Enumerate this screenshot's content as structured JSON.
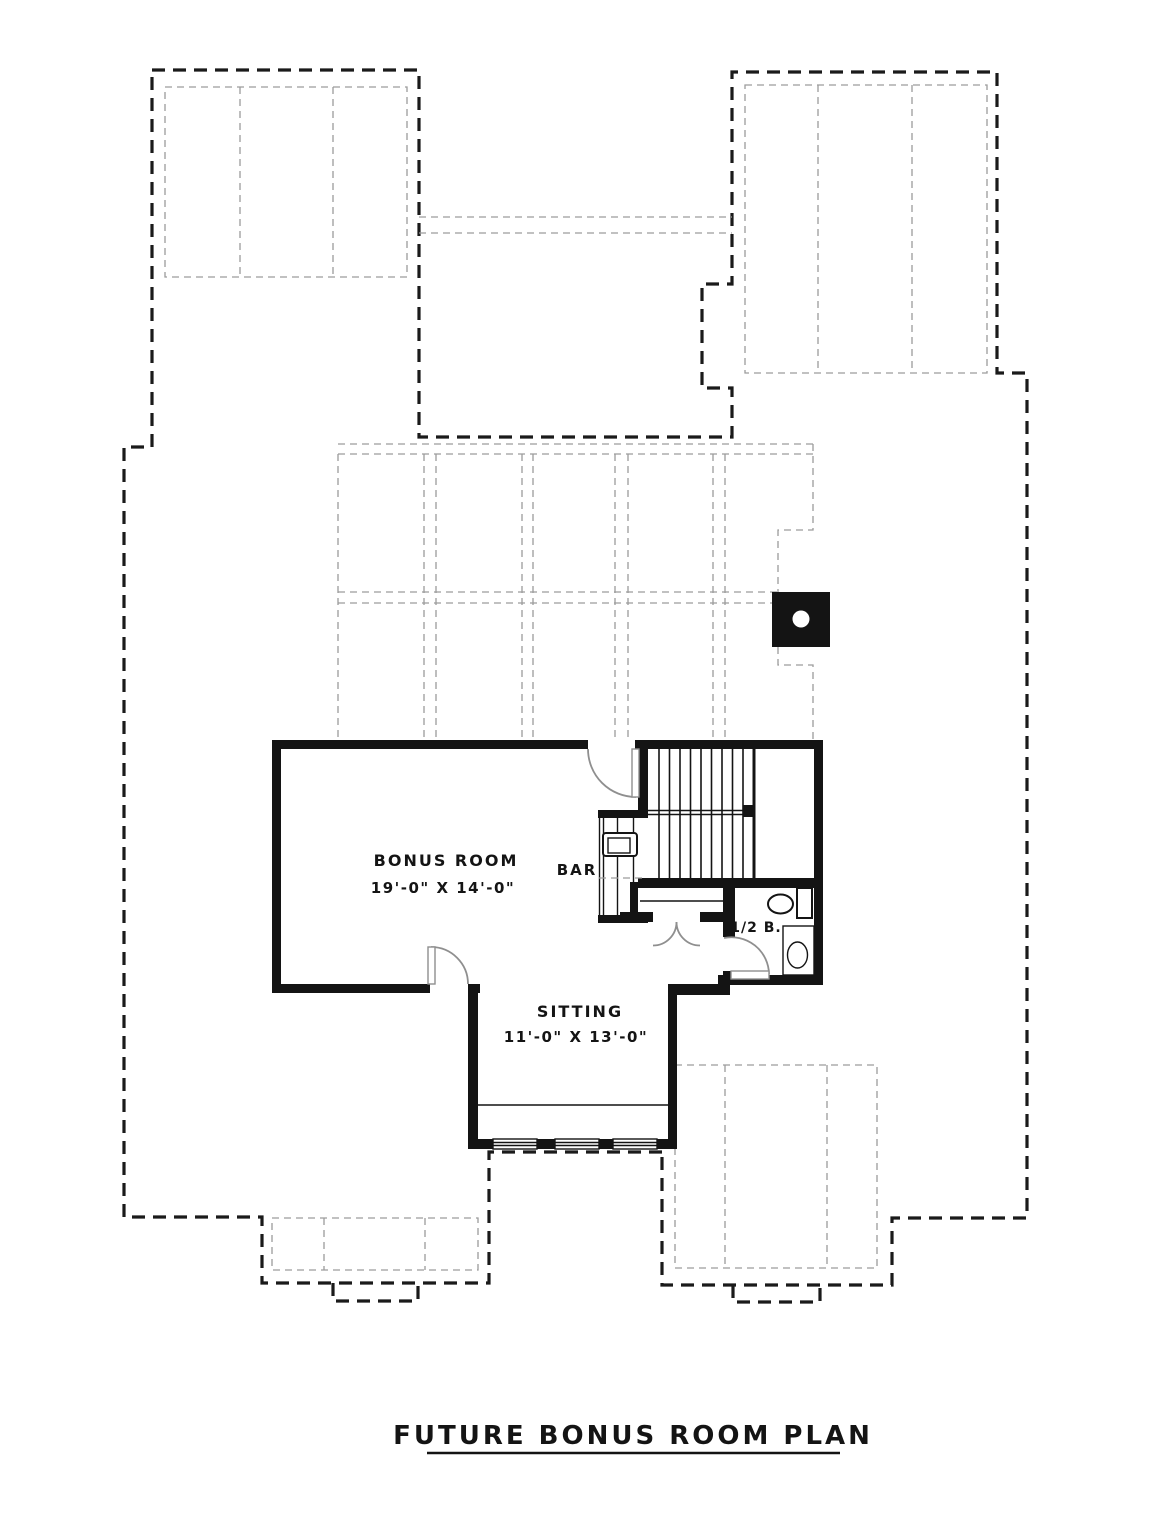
{
  "drawing": {
    "title": "FUTURE BONUS ROOM PLAN",
    "labels": {
      "bonus_room": {
        "name": "BONUS ROOM",
        "dims": "19'-0\" X 14'-0\""
      },
      "sitting": {
        "name": "SITTING",
        "dims": "11'-0\" X 13'-0\""
      },
      "bar": "BAR",
      "half_bath": "1/2 B."
    },
    "colors": {
      "paper": "#ffffff",
      "wall": "#141414",
      "outline_dash": "#1a1a1a",
      "roof_dash": "#9c9c9c",
      "door_arc": "#8f8f8f"
    }
  }
}
